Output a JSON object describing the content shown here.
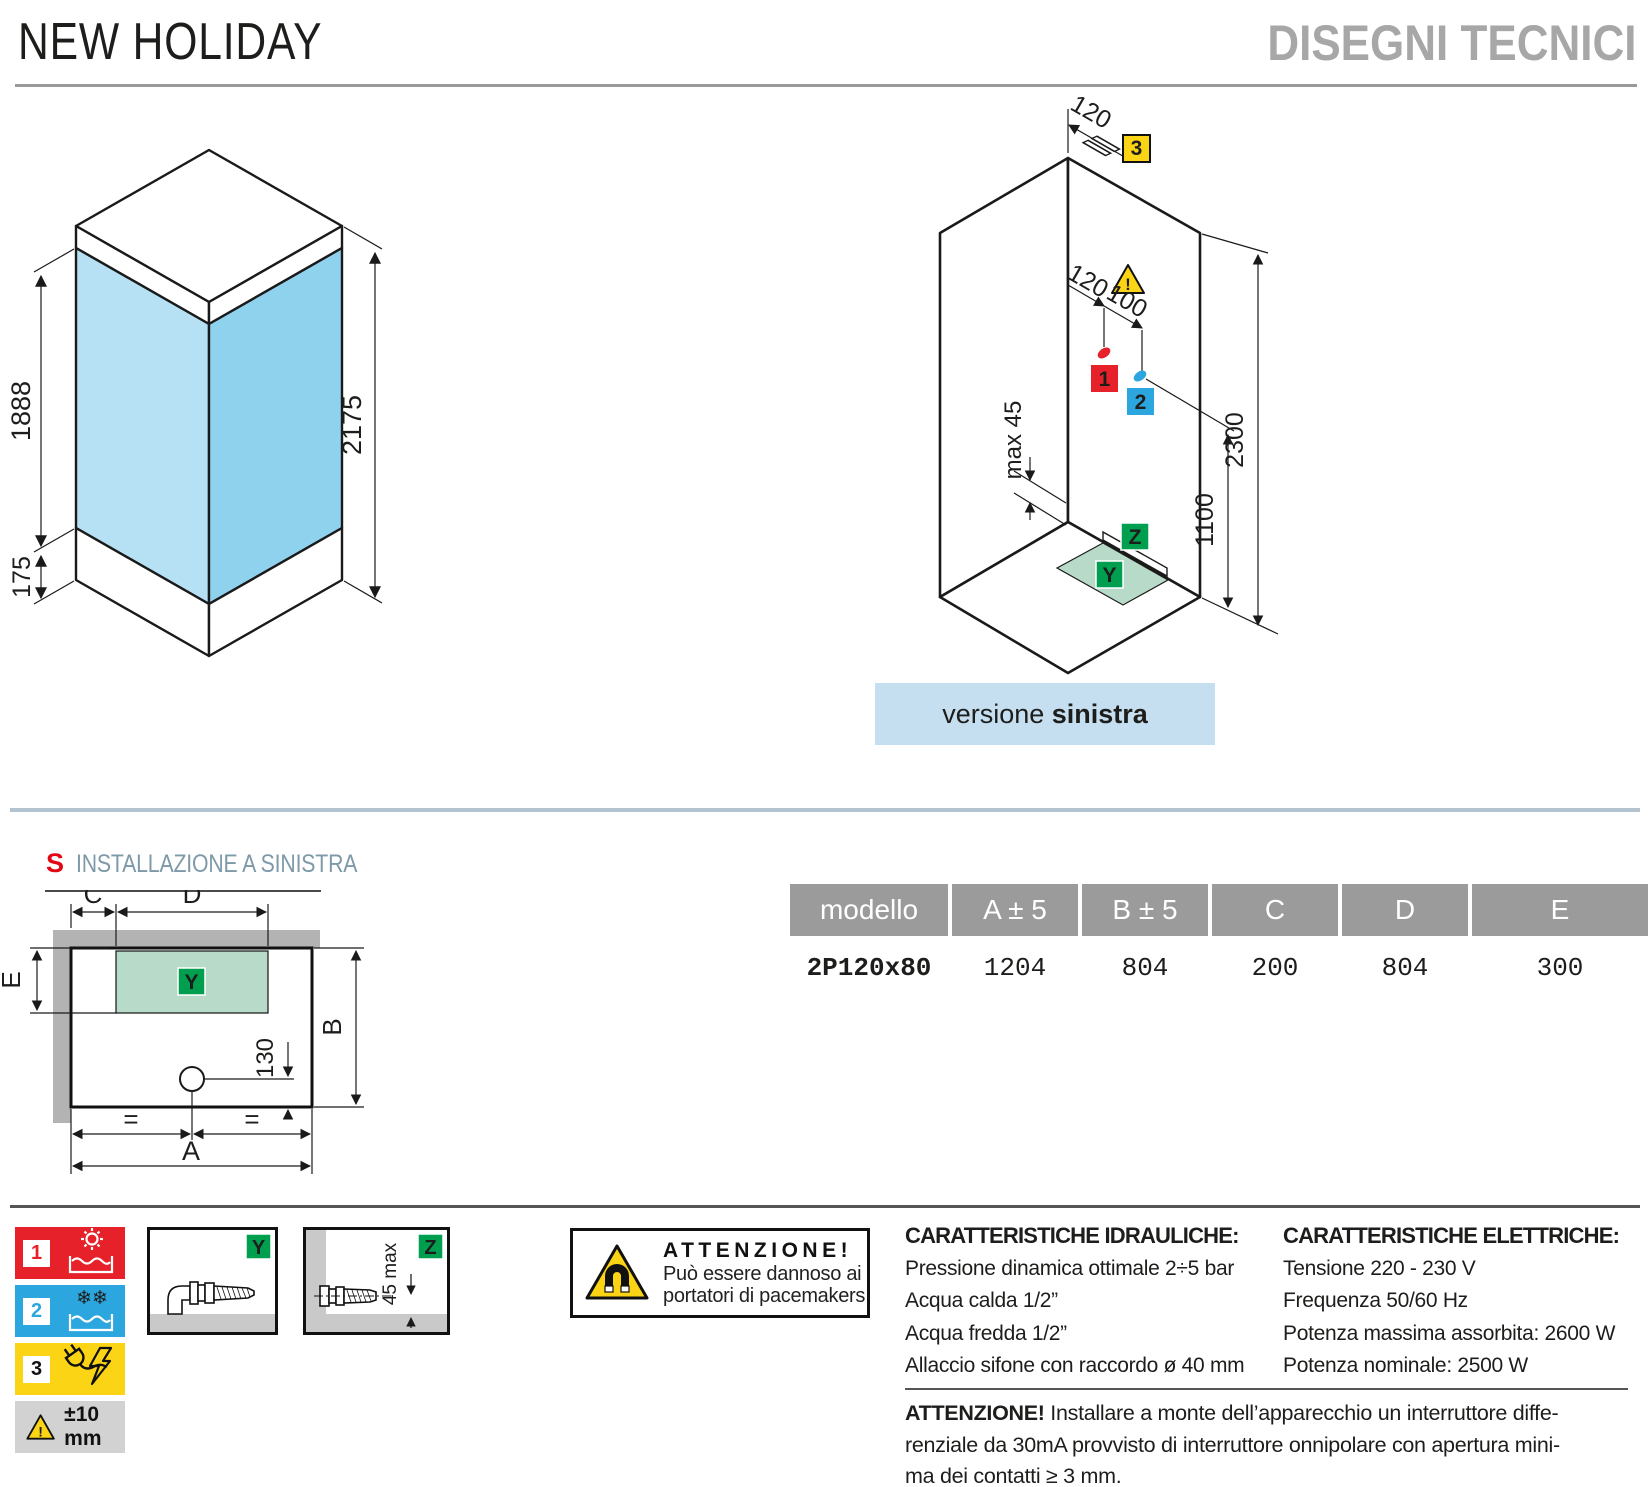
{
  "header": {
    "title": "NEW HOLIDAY",
    "subtitle": "DISEGNI TECNICI"
  },
  "front_view": {
    "height_glass": "1888",
    "height_tray": "175",
    "height_total": "2175"
  },
  "iso_view": {
    "dim_top": "120",
    "dim_c1": "120",
    "dim_c2": "100",
    "dim_max": "max 45",
    "dim_h1": "1100",
    "dim_h2": "2300",
    "badge1": "1",
    "badge2": "2",
    "badge3": "3",
    "badgeY": "Y",
    "badgeZ": "Z",
    "warn": "!",
    "caption_normal": "versione",
    "caption_bold": "sinistra"
  },
  "plan": {
    "letter": "S",
    "title": "INSTALLAZIONE A SINISTRA",
    "dimA": "A",
    "dimB": "B",
    "dimC": "C",
    "dimD": "D",
    "dimE": "E",
    "dim130": "130",
    "eq1": "=",
    "eq2": "=",
    "badgeY": "Y"
  },
  "table": {
    "headers": [
      "modello",
      "A ± 5",
      "B ± 5",
      "C",
      "D",
      "E"
    ],
    "row": [
      "2P120x80",
      "1204",
      "804",
      "200",
      "804",
      "300"
    ]
  },
  "legend": {
    "n1": "1",
    "n2": "2",
    "n3": "3",
    "snow": "❄❄",
    "warn": "!",
    "tolerance": "±10 mm"
  },
  "details": {
    "y": "Y",
    "z": "Z",
    "zdim": "45 max"
  },
  "attention_box": {
    "warn": "!",
    "title": "ATTENZIONE!",
    "line1": "Può essere dannoso ai",
    "line2": "portatori di pacemakers"
  },
  "hydraulic": {
    "title": "CARATTERISTICHE IDRAULICHE:",
    "lines": [
      "Pressione dinamica ottimale 2÷5 bar",
      "Acqua calda 1/2”",
      "Acqua fredda 1/2”",
      "Allaccio sifone con raccordo ø 40 mm"
    ]
  },
  "electric": {
    "title": "CARATTERISTICHE ELETTRICHE:",
    "lines": [
      "Tensione 220 - 230 V",
      "Frequenza 50/60 Hz",
      "Potenza massima assorbita: 2600 W",
      "Potenza nominale: 2500 W"
    ]
  },
  "footer_warning": {
    "bold": "ATTENZIONE!",
    "line1": " Installare a monte dell’apparecchio un interruttore diffe-",
    "line2": "renziale da 30mA provvisto di interruttore onnipolare con apertura mini-",
    "line3": "ma dei contatti ≥ 3 mm."
  },
  "colors": {
    "red": "#e62129",
    "blue": "#2ba6df",
    "yellow": "#fbd515",
    "green": "#009e4f",
    "glass_light": "#b6e1f4",
    "glass_dark": "#8fd2ee",
    "caption_bg": "#c6dff0",
    "table_header": "#9b9b9b",
    "zone_green": "#b7dbc8",
    "wall_gray": "#b3b3b3"
  }
}
